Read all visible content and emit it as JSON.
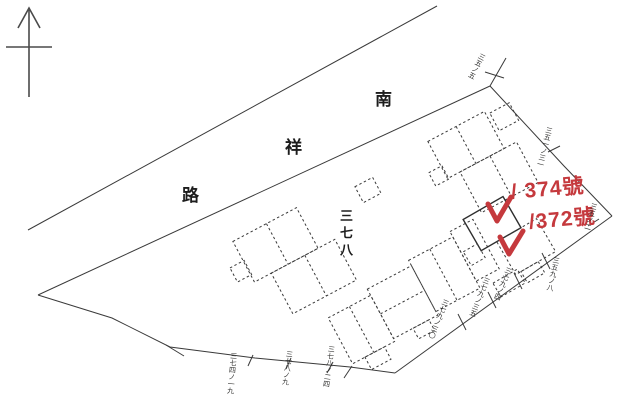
{
  "colors": {
    "ink": "#3a3a3a",
    "red": "#c5393d",
    "paper": "#ffffff"
  },
  "icons": {
    "north_arrow": "north-arrow"
  },
  "road": {
    "name": "南祥路",
    "chars": [
      "南",
      "祥",
      "路"
    ]
  },
  "area_label": {
    "text": "三七八"
  },
  "annotations": {
    "lot_374": "/ 374號",
    "lot_372": "/372號"
  },
  "lot_labels": [
    {
      "text": "三五ノ五"
    },
    {
      "text": "三五一ノ三一"
    },
    {
      "text": "三五ノ二"
    },
    {
      "text": "三五九ノ八"
    },
    {
      "text": "三七九ノ四"
    },
    {
      "text": "三七九ノ三五"
    },
    {
      "text": "三七九ノ三〇"
    },
    {
      "text": "三七八ノ二四"
    },
    {
      "text": "三七八ノ九"
    },
    {
      "text": "三七四ノ一九"
    }
  ]
}
